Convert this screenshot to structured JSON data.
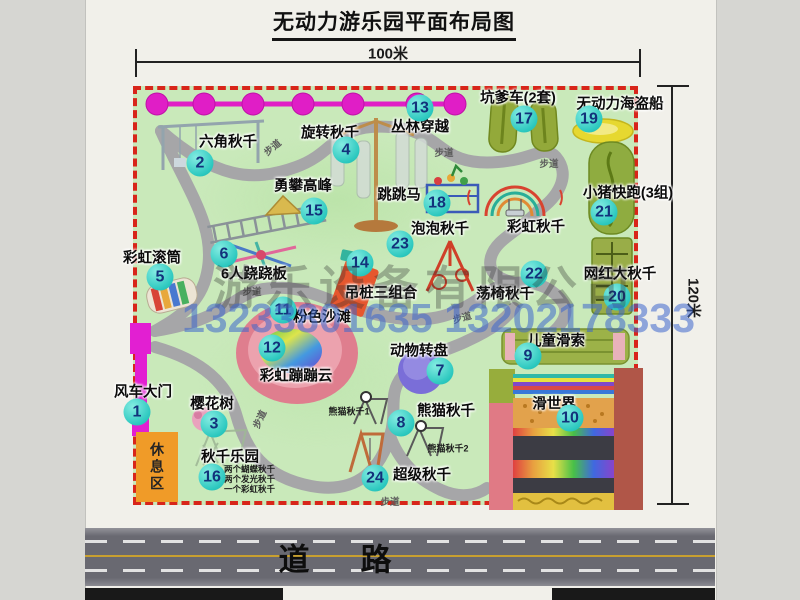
{
  "title": "无动力游乐园平面布局图",
  "dimensions": {
    "width": "100米",
    "height": "120米"
  },
  "road": {
    "label": "道　路"
  },
  "watermark": {
    "company": "游乐设备有限公司",
    "phone": "13233801635 13202178333"
  },
  "rest_area": {
    "label": "休息区"
  },
  "colors": {
    "map_green": "#c9e9ba",
    "border_red": "#d8251a",
    "badge_cyan": "#2cc8bf",
    "badge_text": "#12327b",
    "magenta": "#e01ec6",
    "rest_orange": "#f09b28",
    "path_gray": "#a6a6a8",
    "olive_green": "#93a93a",
    "pink_beach": "#df7e8e"
  },
  "items": [
    {
      "num": "1",
      "label": "风车大门",
      "bx": 137,
      "by": 412,
      "lx": 143,
      "ly": 391
    },
    {
      "num": "2",
      "label": "六角秋千",
      "bx": 200,
      "by": 163,
      "lx": 228,
      "ly": 141
    },
    {
      "num": "3",
      "label": "樱花树",
      "bx": 214,
      "by": 424,
      "lx": 212,
      "ly": 403
    },
    {
      "num": "4",
      "label": "旋转秋千",
      "bx": 346,
      "by": 150,
      "lx": 330,
      "ly": 132
    },
    {
      "num": "5",
      "label": "彩虹滚筒",
      "bx": 160,
      "by": 277,
      "lx": 152,
      "ly": 257
    },
    {
      "num": "6",
      "label": "6人跷跷板",
      "bx": 224,
      "by": 254,
      "lx": 254,
      "ly": 273
    },
    {
      "num": "7",
      "label": "动物转盘",
      "bx": 440,
      "by": 371,
      "lx": 419,
      "ly": 350
    },
    {
      "num": "8",
      "label": "熊猫秋千",
      "bx": 401,
      "by": 423,
      "lx": 446,
      "ly": 410
    },
    {
      "num": "9",
      "label": "儿童滑索",
      "bx": 528,
      "by": 356,
      "lx": 556,
      "ly": 340
    },
    {
      "num": "10",
      "label": "滑世界",
      "bx": 570,
      "by": 418,
      "lx": 554,
      "ly": 403
    },
    {
      "num": "11",
      "label": "粉色沙滩",
      "bx": 283,
      "by": 310,
      "lx": 322,
      "ly": 316
    },
    {
      "num": "12",
      "label": "彩虹蹦蹦云",
      "bx": 272,
      "by": 348,
      "lx": 296,
      "ly": 375
    },
    {
      "num": "13",
      "label": "丛林穿越",
      "bx": 420,
      "by": 108,
      "lx": 420,
      "ly": 126
    },
    {
      "num": "14",
      "label": "吊桩三组合",
      "bx": 360,
      "by": 263,
      "lx": 381,
      "ly": 292
    },
    {
      "num": "15",
      "label": "勇攀高峰",
      "bx": 314,
      "by": 211,
      "lx": 303,
      "ly": 185
    },
    {
      "num": "16",
      "label": "秋千乐园",
      "bx": 212,
      "by": 477,
      "lx": 230,
      "ly": 456,
      "subs": [
        "两个蝴蝶秋千",
        "两个发光秋千",
        "一个彩虹秋千"
      ]
    },
    {
      "num": "17",
      "label": "坑爹车(2套)",
      "bx": 524,
      "by": 119,
      "lx": 518,
      "ly": 97
    },
    {
      "num": "18",
      "label": "跳跳马",
      "bx": 437,
      "by": 203,
      "lx": 399,
      "ly": 194
    },
    {
      "num": "19",
      "label": "无动力海盗船",
      "bx": 589,
      "by": 119,
      "lx": 620,
      "ly": 103
    },
    {
      "num": "20",
      "label": "网红大秋千",
      "bx": 617,
      "by": 297,
      "lx": 620,
      "ly": 273
    },
    {
      "num": "21",
      "label": "小猪快跑(3组)",
      "bx": 604,
      "by": 212,
      "lx": 628,
      "ly": 192
    },
    {
      "num": "22",
      "label": "荡椅秋千",
      "bx": 534,
      "by": 274,
      "lx": 505,
      "ly": 293
    },
    {
      "num": "23",
      "label": "泡泡秋千",
      "bx": 400,
      "by": 244,
      "lx": 440,
      "ly": 228
    },
    {
      "num": "24",
      "label": "超级秋千",
      "bx": 375,
      "by": 478,
      "lx": 422,
      "ly": 474
    }
  ],
  "extra_labels": [
    {
      "text": "彩虹秋千",
      "x": 536,
      "y": 226,
      "cls": "map-label",
      "name": "rainbow-arch-swing-label"
    },
    {
      "text": "熊猫秋千1",
      "x": 349,
      "y": 411,
      "cls": "small-label",
      "name": "panda-swing-1-label"
    },
    {
      "text": "熊猫秋千2",
      "x": 448,
      "y": 448,
      "cls": "small-label",
      "name": "panda-swing-2-label"
    },
    {
      "text": "步道",
      "x": 272,
      "y": 147,
      "rot": -40,
      "name": "walkway-label-1"
    },
    {
      "text": "步道",
      "x": 444,
      "y": 152,
      "rot": 0,
      "name": "walkway-label-2"
    },
    {
      "text": "步道",
      "x": 549,
      "y": 163,
      "rot": 0,
      "name": "walkway-label-3"
    },
    {
      "text": "步道",
      "x": 252,
      "y": 291,
      "rot": 0,
      "name": "walkway-label-4"
    },
    {
      "text": "步道",
      "x": 462,
      "y": 317,
      "rot": -15,
      "name": "walkway-label-5"
    },
    {
      "text": "步道",
      "x": 259,
      "y": 419,
      "rot": -65,
      "name": "walkway-label-6"
    },
    {
      "text": "步道",
      "x": 390,
      "y": 501,
      "rot": 0,
      "name": "walkway-label-7"
    }
  ]
}
